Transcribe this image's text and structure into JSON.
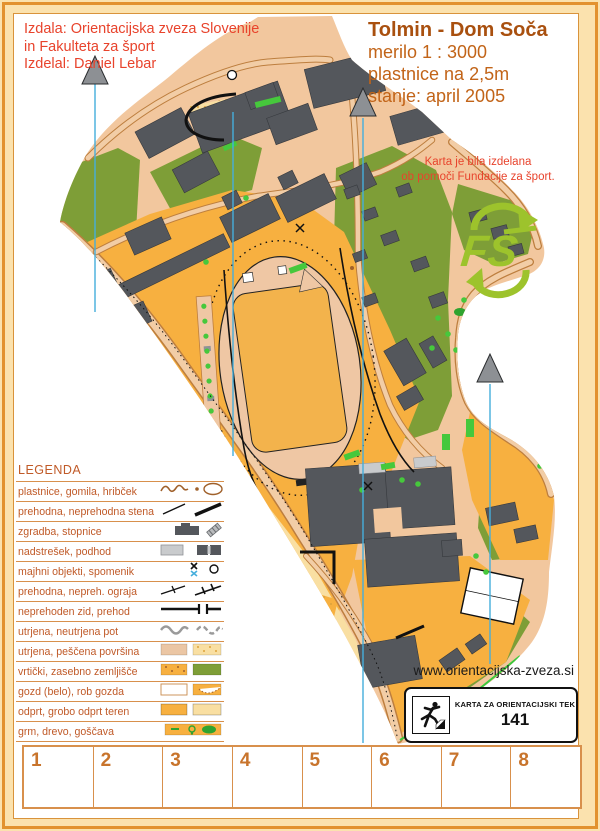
{
  "colors": {
    "cream": "#FBE2AE",
    "frame": "#E2922F",
    "sheetborder": "#D9933B",
    "base": "#F2C79E",
    "track": "#EFC7A4",
    "road": "#F2CDA6",
    "roadedge": "#BD7E3E",
    "orange": "#F7B040",
    "pale": "#F9DFA2",
    "olive": "#7E9E37",
    "bgreen": "#46C83C",
    "dgreen": "#2FA32F",
    "bld": "#54575C",
    "bldedge": "#36393D",
    "lgray": "#C9CBCD",
    "north": "#45AEDC",
    "arrow": "#8D9094",
    "red": "#E8432C",
    "titlebrown": "#A9500F",
    "titleorange": "#C26418",
    "legendtext": "#C05A28",
    "legendline": "#D8904C",
    "punch": "#C8742C",
    "fsgreen": "#9DC32C"
  },
  "credits": {
    "line1": "Izdala: Orientacijska zveza Slovenije",
    "line2": "in Fakulteta za šport",
    "line3": "Izdelal: Daniel Lebar"
  },
  "title_block": {
    "title": "Tolmin - Dom Soča",
    "scale": "merilo 1 : 3000",
    "contours": "plastnice na 2,5m",
    "status": "stanje: april 2005"
  },
  "funding_note": {
    "line1": "Karta je bila izdelana",
    "line2": "ob pomoči Fundacije za šport."
  },
  "fs_logo": {
    "label": "FS",
    "icon": "fs-foundation-logo"
  },
  "legend": {
    "heading": "LEGENDA",
    "items": [
      {
        "label": "plastnice, gomila, hribček",
        "symbol": "contour-knoll-hill-symbol"
      },
      {
        "label": "prehodna, neprehodna stena",
        "symbol": "wall-symbol"
      },
      {
        "label": "zgradba, stopnice",
        "symbol": "building-stairs-symbol"
      },
      {
        "label": "nadstrešek, podhod",
        "symbol": "canopy-passage-symbol"
      },
      {
        "label": "majhni objekti, spomenik",
        "symbol": "small-object-monument-symbol"
      },
      {
        "label": "prehodna, nepreh. ograja",
        "symbol": "fence-symbol"
      },
      {
        "label": "neprehoden zid, prehod",
        "symbol": "impassable-wall-gap-symbol"
      },
      {
        "label": "utrjena, neutrjena pot",
        "symbol": "path-symbol"
      },
      {
        "label": "utrjena, peščena površina",
        "symbol": "paved-sand-swatch"
      },
      {
        "label": "vrtički, zasebno zemljišče",
        "symbol": "allotment-private-swatch"
      },
      {
        "label": "gozd (belo), rob gozda",
        "symbol": "forest-edge-swatch"
      },
      {
        "label": "odprt, grobo odprt teren",
        "symbol": "open-terrain-swatch"
      },
      {
        "label": "grm, drevo, goščava",
        "symbol": "bush-tree-thicket-swatch"
      }
    ]
  },
  "footer": {
    "website": "www.orientacijska-zveza.si",
    "card_title": "KARTA ZA ORIENTACIJSKI TEK",
    "card_number": "141",
    "runner_icon": "orienteering-runner-icon"
  },
  "punch_row": {
    "numbers": [
      "1",
      "2",
      "3",
      "4",
      "5",
      "6",
      "7",
      "8"
    ]
  },
  "map": {
    "north_arrow_icon": "north-arrow-icon",
    "north_line_xs": [
      95,
      233,
      363,
      490
    ]
  }
}
